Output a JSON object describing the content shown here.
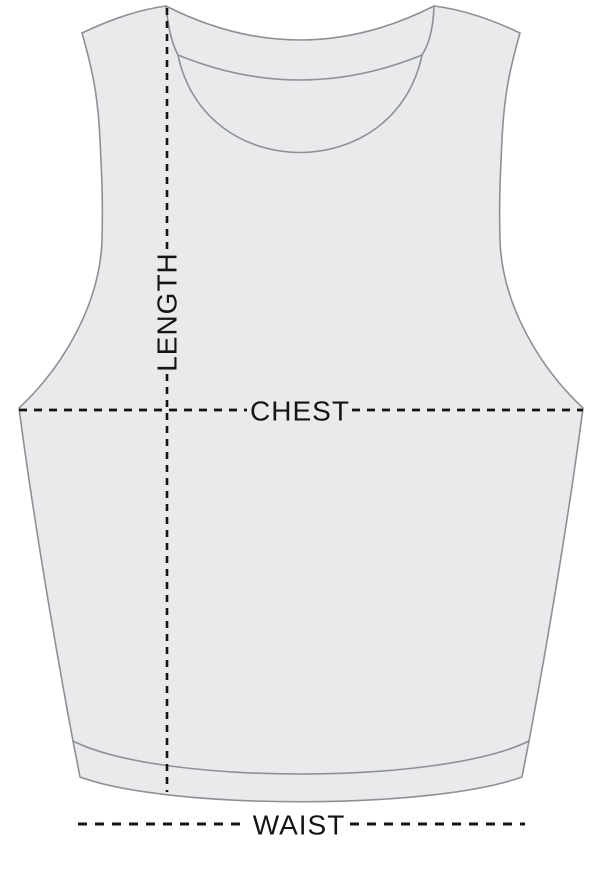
{
  "diagram": {
    "type": "garment-measurement-size-guide",
    "garment": "sleeveless crop tank top, front view",
    "labels": {
      "length": "LENGTH",
      "chest": "CHEST",
      "waist": "WAIST"
    },
    "colors": {
      "background": "#ffffff",
      "garment_fill": "#e9eaec",
      "garment_outline": "#8d9095",
      "measurement_line": "#141414",
      "label_text": "#141414"
    }
  }
}
